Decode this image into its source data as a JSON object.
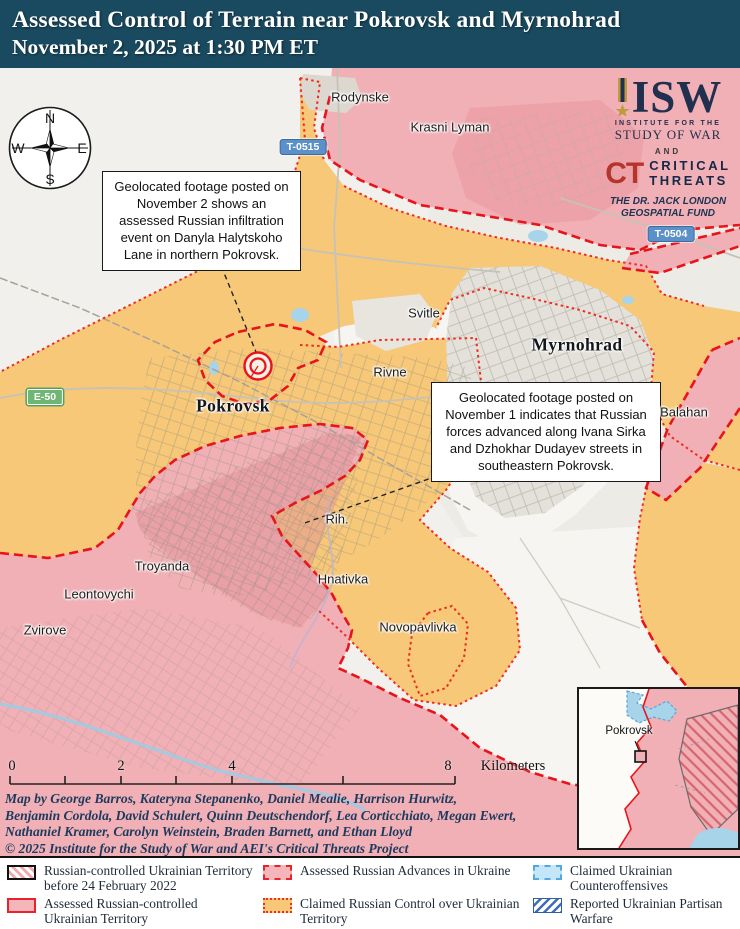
{
  "header": {
    "title_line1": "Assessed Control of Terrain near Pokrovsk and Myrnohrad",
    "title_line2": "November 2, 2025 at 1:30 PM ET"
  },
  "logo": {
    "isw": "ISW",
    "inst_line1": "INSTITUTE FOR THE",
    "inst_line2": "STUDY OF WAR",
    "and": "AND",
    "ct": "CT",
    "ct_line1": "CRITICAL",
    "ct_line2": "THREATS",
    "fund_line1": "THE DR. JACK LONDON",
    "fund_line2": "GEOSPATIAL FUND"
  },
  "compass": {
    "n": "N",
    "e": "E",
    "s": "S",
    "w": "W"
  },
  "callouts": {
    "c1": "Geolocated footage posted on November 2 shows an assessed Russian infiltration event on Danyla Halytskoho Lane in northern Pokrovsk.",
    "c2": "Geolocated footage posted on November 1 indicates that Russian forces advanced along Ivana Sirka and Dzhokhar Dudayev streets in southeastern Pokrovsk."
  },
  "map_labels": {
    "towns": [
      "Rodynske",
      "Krasni Lyman",
      "Svitle",
      "Rivne",
      "Balahan",
      "Rih.",
      "Troyanda",
      "Hnativka",
      "Leontovychi",
      "Zvirove",
      "Novopavlivka"
    ],
    "cities": [
      "Pokrovsk",
      "Myrnohrad"
    ],
    "roads": [
      "T-0515",
      "T-0504",
      "E-50"
    ]
  },
  "scale": {
    "ticks": [
      "0",
      "2",
      "4",
      "8"
    ],
    "unit": "Kilometers"
  },
  "credits": {
    "line1": "Map by George Barros, Kateryna Stepanenko, Daniel Mealie, Harrison Hurwitz,",
    "line2": "Benjamin Cordola, David Schulert, Quinn Deutschendorf, Lea Corticchiato, Megan Ewert,",
    "line3": "Nathaniel Kramer, Carolyn Weinstein, Braden Barnett, and Ethan Lloyd",
    "line4": "© 2025 Institute for the Study of War and AEI's Critical Threats Project"
  },
  "inset": {
    "label": "Pokrovsk"
  },
  "legend": {
    "items": [
      {
        "label": "Russian-controlled Ukrainian Territory before 24 February 2022"
      },
      {
        "label": "Assessed Russian Advances in Ukraine"
      },
      {
        "label": "Claimed Ukrainian Counteroffensives"
      },
      {
        "label": "Assessed Russian-controlled Ukrainian Territory"
      },
      {
        "label": "Claimed Russian Control over Ukrainian Territory"
      },
      {
        "label": "Reported Ukrainian Partisan Warfare"
      }
    ]
  },
  "colors": {
    "header_bg": "#1a4a5f",
    "claimed_russian_orange": "#f6c878",
    "assessed_russian_pink": "#f0b0b5",
    "red_border": "#e8131b",
    "counteroffensive_blue": "#55a7e0",
    "water_blue": "#a8d4ea",
    "isw_navy": "#22304f",
    "ct_red": "#b5352c"
  }
}
